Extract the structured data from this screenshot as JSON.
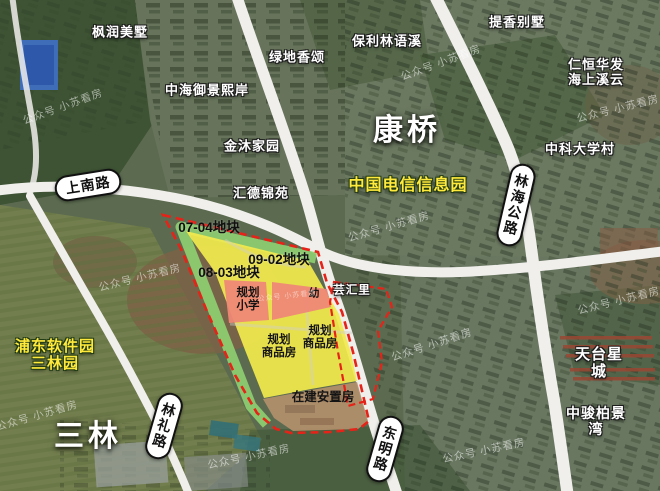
{
  "map": {
    "city_labels": [
      {
        "id": "kangqiao",
        "text": "康桥"
      },
      {
        "id": "sanlin",
        "text": "三林"
      }
    ],
    "place_labels": [
      {
        "id": "fengrun-villa",
        "text": "枫润美墅"
      },
      {
        "id": "lvdi-xiangsong",
        "text": "绿地香颂"
      },
      {
        "id": "baoli-linyuxi",
        "text": "保利林语溪"
      },
      {
        "id": "tixiang-villa",
        "text": "提香别墅"
      },
      {
        "id": "renheng-huafa",
        "text": "仁恒华发\n海上溪云"
      },
      {
        "id": "zhonghai-yujingxian",
        "text": "中海御景熙岸"
      },
      {
        "id": "jinmu-jiayuan",
        "text": "金沐家园"
      },
      {
        "id": "zhongke-daxuecun",
        "text": "中科大学村"
      },
      {
        "id": "huide-jinyuan",
        "text": "汇德锦苑"
      },
      {
        "id": "tiantai-xingcheng",
        "text": "天台星城"
      },
      {
        "id": "zhongjun-bojingwan",
        "text": "中骏柏景湾"
      },
      {
        "id": "yunhuili",
        "text": "芸汇里"
      }
    ],
    "highlight_labels": [
      {
        "id": "telecom-park",
        "text": "中国电信信息园"
      },
      {
        "id": "pudong-software-park",
        "text": "浦东软件园\n三林园"
      }
    ],
    "road_labels": [
      {
        "id": "shangnan-road",
        "text": "上南路"
      },
      {
        "id": "linhai-highway",
        "text": "林海公路"
      },
      {
        "id": "linli-road",
        "text": "林礼路"
      },
      {
        "id": "dongming-road",
        "text": "东明路"
      }
    ],
    "parcel_labels": [
      {
        "id": "parcel-07-04",
        "text": "07-04地块"
      },
      {
        "id": "parcel-09-02",
        "text": "09-02地块"
      },
      {
        "id": "parcel-08-03",
        "text": "08-03地块"
      }
    ],
    "zone_labels": [
      {
        "id": "planned-school",
        "text": "规划\n小学"
      },
      {
        "id": "kindergarten",
        "text": "幼"
      },
      {
        "id": "planned-housing-1",
        "text": "规划\n商品房"
      },
      {
        "id": "planned-housing-2",
        "text": "规划\n商品房"
      },
      {
        "id": "resettlement",
        "text": "在建安置房"
      }
    ],
    "watermark": {
      "text": "公众号 小苏看房"
    },
    "colors": {
      "parcel_yellow": "#f2e94d",
      "school_pink": "#ee8876",
      "green_buffer": "#8fd071",
      "boundary_red": "#e62318",
      "road_white": "#f0efec",
      "highlight_yellow": "#ffe93c"
    }
  }
}
